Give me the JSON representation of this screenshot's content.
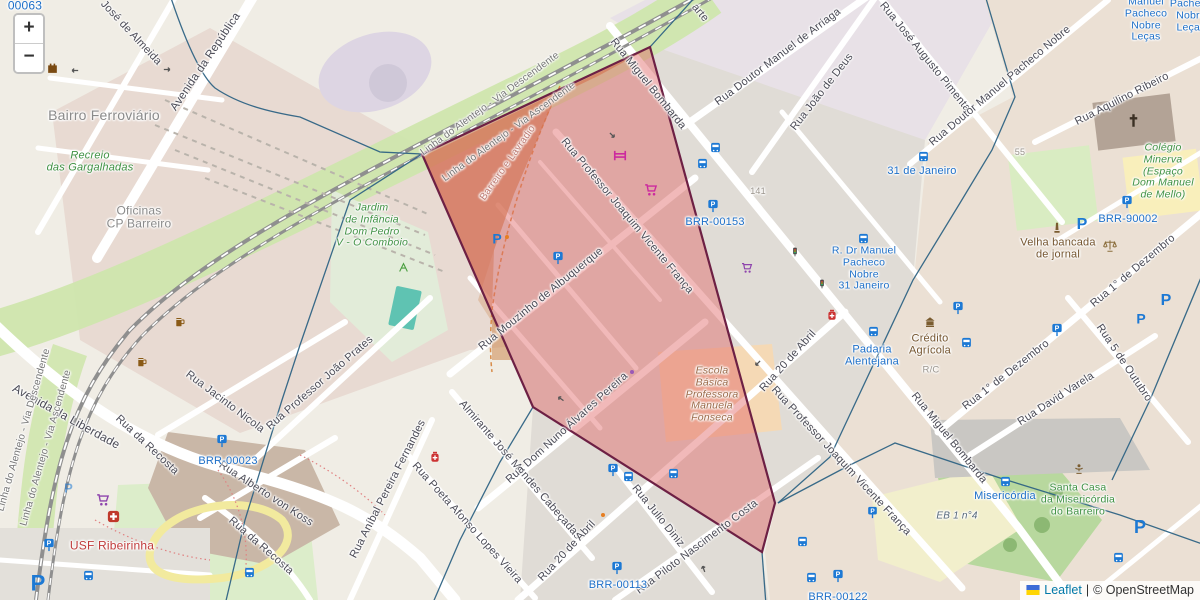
{
  "controls": {
    "zoom_in": "+",
    "zoom_out": "−"
  },
  "attribution": {
    "flag_icon": "ukraine-flag-icon",
    "leaflet_link": "Leaflet",
    "separator": "|",
    "copyright": "© OpenStreetMap"
  },
  "colors": {
    "street_label": "#4a4a55",
    "rail_label": "#767676",
    "place_label": "#8a8a8a",
    "green_poi": "#3f9143",
    "brown_poi": "#75552f",
    "school_brown": "#9c6b4a",
    "red_poi": "#c03c3c",
    "transit_blue": "#1d6fc8",
    "admin_label": "#bd7a72",
    "housenum": "#9a948c",
    "eb_label": "#56687a",
    "boundary_blue": "#2e6384",
    "polygon_fill": "#e06666",
    "polygon_border": "#6d2044",
    "attr_link": "#0078a8"
  },
  "polygon": {
    "name": "highlighted-red-zone",
    "points": "650,47 775,503 762,552 533,407 422,154"
  },
  "labels": [
    {
      "id": "corner-id",
      "text": "00063",
      "x": 25,
      "y": 6,
      "rot": 0,
      "size": 12,
      "c": "transit"
    },
    {
      "id": "jose-de-almeida",
      "text": "José de Almeida",
      "x": 131,
      "y": 33,
      "rot": 47,
      "size": 11,
      "c": "street"
    },
    {
      "id": "avenida-republica",
      "text": "Avenida da República",
      "x": 206,
      "y": 62,
      "rot": -56,
      "size": 11.5,
      "c": "street"
    },
    {
      "id": "avenida-liberdade",
      "text": "Avenida da Liberdade",
      "x": 66,
      "y": 417,
      "rot": 29,
      "size": 12,
      "c": "street"
    },
    {
      "id": "linha-desc-top",
      "text": "Linha do Alentejo - Via Descendente",
      "x": 490,
      "y": 104,
      "rot": -36,
      "size": 10,
      "c": "rail"
    },
    {
      "id": "linha-asc-top",
      "text": "Linha do Alentejo - Via Ascendente",
      "x": 509,
      "y": 132,
      "rot": -36,
      "size": 10,
      "c": "rail"
    },
    {
      "id": "linha-desc-left",
      "text": "Linha do Alentejo - Via Descendente",
      "x": 24,
      "y": 430,
      "rot": -74,
      "size": 10,
      "c": "rail"
    },
    {
      "id": "linha-asc-left",
      "text": "Linha do Alentejo - Via Ascendente",
      "x": 46,
      "y": 448,
      "rot": -74,
      "size": 10,
      "c": "rail"
    },
    {
      "id": "recosta-1",
      "text": "Rua da Recosta",
      "x": 147,
      "y": 445,
      "rot": 43,
      "size": 11,
      "c": "street"
    },
    {
      "id": "recosta-2",
      "text": "Rua da Recosta",
      "x": 261,
      "y": 546,
      "rot": 41,
      "size": 11,
      "c": "street"
    },
    {
      "id": "jacinto-nicola",
      "text": "Rua Jacinto Nicola",
      "x": 225,
      "y": 402,
      "rot": 37,
      "size": 11,
      "c": "street"
    },
    {
      "id": "joao-prates",
      "text": "Rua Professor João Prates",
      "x": 320,
      "y": 383,
      "rot": -41,
      "size": 11,
      "c": "street"
    },
    {
      "id": "alberto-koss",
      "text": "Rua Alberto von Koss",
      "x": 266,
      "y": 494,
      "rot": 33,
      "size": 11,
      "c": "street"
    },
    {
      "id": "anibal-fernandes",
      "text": "Rua Aníbal Pereira Fernandes",
      "x": 388,
      "y": 489,
      "rot": -63,
      "size": 11,
      "c": "street"
    },
    {
      "id": "poeta-afonso",
      "text": "Rua Poeta Afonso Lopes Vieira",
      "x": 467,
      "y": 523,
      "rot": 48,
      "size": 11,
      "c": "street"
    },
    {
      "id": "almirante-cabecadas",
      "text": "Almirante José Mendes Cabeçadas",
      "x": 520,
      "y": 470,
      "rot": 49,
      "size": 11,
      "c": "street"
    },
    {
      "id": "dom-nuno",
      "text": "Rua Dom Nuno Álvares Pereira",
      "x": 567,
      "y": 428,
      "rot": -42,
      "size": 11,
      "c": "street"
    },
    {
      "id": "mouzinho",
      "text": "Rua Mouzinho de Albuquerque",
      "x": 541,
      "y": 299,
      "rot": -39,
      "size": 11,
      "c": "street"
    },
    {
      "id": "franca-top",
      "text": "Rua Professor Joaquim Vicente França",
      "x": 627,
      "y": 216,
      "rot": 50,
      "size": 11,
      "c": "street"
    },
    {
      "id": "franca-right",
      "text": "Rua Professor Joaquim Vicente França",
      "x": 841,
      "y": 461,
      "rot": 47,
      "size": 11,
      "c": "street"
    },
    {
      "id": "bombarda-top",
      "text": "Rua Miguel Bombarda",
      "x": 648,
      "y": 84,
      "rot": 51,
      "size": 11,
      "c": "street"
    },
    {
      "id": "bombarda-bottom",
      "text": "Rua Miguel Bombarda",
      "x": 949,
      "y": 438,
      "rot": 51,
      "size": 11,
      "c": "street"
    },
    {
      "id": "arriaga",
      "text": "Rua Doutor Manuel de Arriaga",
      "x": 778,
      "y": 57,
      "rot": -37,
      "size": 11,
      "c": "street"
    },
    {
      "id": "joao-deus",
      "text": "Rua João de Deus",
      "x": 822,
      "y": 92,
      "rot": -52,
      "size": 11,
      "c": "street"
    },
    {
      "id": "jose-pimenta",
      "text": "Rua José Augusto Pimenta",
      "x": 925,
      "y": 57,
      "rot": 51,
      "size": 11,
      "c": "street"
    },
    {
      "id": "pacheco-nobre-street",
      "text": "Rua Doutor Manuel Pacheco Nobre",
      "x": 1000,
      "y": 86,
      "rot": -40,
      "size": 11,
      "c": "street"
    },
    {
      "id": "aquilino-ribeiro",
      "text": "Rua Aquilino Ribeiro",
      "x": 1122,
      "y": 99,
      "rot": -27,
      "size": 11,
      "c": "street"
    },
    {
      "id": "dezembro-1",
      "text": "Rua 1° de Dezembro",
      "x": 1006,
      "y": 375,
      "rot": -38,
      "size": 11,
      "c": "street"
    },
    {
      "id": "dezembro-2",
      "text": "Rua 1° de Dezembro",
      "x": 1133,
      "y": 271,
      "rot": -40,
      "size": 11,
      "c": "street"
    },
    {
      "id": "outubro-5",
      "text": "Rua 5 de Outubro",
      "x": 1124,
      "y": 363,
      "rot": 56,
      "size": 11,
      "c": "street"
    },
    {
      "id": "david-varela",
      "text": "Rua David Varela",
      "x": 1056,
      "y": 399,
      "rot": -33,
      "size": 11,
      "c": "street"
    },
    {
      "id": "abril-20-1",
      "text": "Rua 20 de Abril",
      "x": 567,
      "y": 551,
      "rot": -47,
      "size": 11,
      "c": "street"
    },
    {
      "id": "abril-20-2",
      "text": "Rua 20 de Abril",
      "x": 788,
      "y": 361,
      "rot": -48,
      "size": 11,
      "c": "street"
    },
    {
      "id": "julio-diniz",
      "text": "Rua Julio Diniz",
      "x": 658,
      "y": 516,
      "rot": 51,
      "size": 11,
      "c": "street"
    },
    {
      "id": "piloto-nascimento",
      "text": "Rua Piloto Nascimento Costa",
      "x": 697,
      "y": 547,
      "rot": -37,
      "size": 11,
      "c": "street"
    },
    {
      "id": "barreiro-lavradio",
      "text": "Barreiro e Lavradio",
      "x": 508,
      "y": 163,
      "rot": -55,
      "size": 10,
      "c": "admin"
    },
    {
      "id": "arte-partial",
      "text": "arte",
      "x": 700,
      "y": 13,
      "rot": 50,
      "size": 11,
      "c": "street"
    },
    {
      "id": "bairro-ferroviario",
      "text": "Bairro Ferroviário",
      "x": 104,
      "y": 116,
      "rot": 0,
      "size": 14,
      "c": "place"
    },
    {
      "id": "recreio",
      "lines": [
        "Recreio",
        "das Gargalhadas"
      ],
      "x": 90,
      "y": 162,
      "rot": 0,
      "size": 11,
      "c": "green",
      "italic": true
    },
    {
      "id": "oficinas",
      "lines": [
        "Oficinas",
        "CP Barreiro"
      ],
      "x": 139,
      "y": 218,
      "rot": 0,
      "size": 12,
      "c": "place"
    },
    {
      "id": "jardim-infancia",
      "lines": [
        "Jardim",
        "de Infância",
        "Dom Pedro",
        "V - O Comboio"
      ],
      "x": 372,
      "y": 226,
      "rot": 0,
      "size": 10.5,
      "c": "green",
      "italic": true
    },
    {
      "id": "escola-basica",
      "lines": [
        "Escola",
        "Básica",
        "Professora",
        "Manuela",
        "Fonseca"
      ],
      "x": 712,
      "y": 395,
      "rot": 0,
      "size": 10.5,
      "c": "school",
      "italic": true
    },
    {
      "id": "colegio-minerva",
      "lines": [
        "Colégio",
        "Minerva",
        "(Espaço",
        "Dom Manuel",
        "de Mello)"
      ],
      "x": 1163,
      "y": 172,
      "rot": 0,
      "size": 10.5,
      "c": "green",
      "italic": true
    },
    {
      "id": "velha-bancada",
      "lines": [
        "Velha bancada",
        "de jornal"
      ],
      "x": 1058,
      "y": 249,
      "rot": 0,
      "size": 11,
      "c": "brown"
    },
    {
      "id": "santa-casa",
      "lines": [
        "Santa Casa",
        "da Misericórdia",
        "do Barreiro"
      ],
      "x": 1078,
      "y": 500,
      "rot": 0,
      "size": 10.5,
      "c": "green"
    },
    {
      "id": "credito-agricola",
      "lines": [
        "Crédito",
        "Agrícola"
      ],
      "x": 930,
      "y": 345,
      "rot": 0,
      "size": 11,
      "c": "brown"
    },
    {
      "id": "usf-ribeirinha",
      "text": "USF Ribeirinha",
      "x": 112,
      "y": 546,
      "rot": 0,
      "size": 12,
      "c": "red"
    },
    {
      "id": "eb-1-n4",
      "text": "EB 1 n°4",
      "x": 957,
      "y": 516,
      "rot": 0,
      "size": 10,
      "c": "eb",
      "italic": true
    },
    {
      "id": "brr-00153",
      "text": "BRR-00153",
      "x": 715,
      "y": 222,
      "rot": 0,
      "size": 11,
      "c": "transit"
    },
    {
      "id": "brr-00023",
      "text": "BRR-00023",
      "x": 228,
      "y": 461,
      "rot": 0,
      "size": 11,
      "c": "transit"
    },
    {
      "id": "brr-00113",
      "text": "BRR-00113",
      "x": 618,
      "y": 585,
      "rot": 0,
      "size": 11,
      "c": "transit"
    },
    {
      "id": "brr-00122",
      "text": "BRR-00122",
      "x": 838,
      "y": 597,
      "rot": 0,
      "size": 11,
      "c": "transit"
    },
    {
      "id": "brr-90002",
      "text": "BRR-90002",
      "x": 1128,
      "y": 219,
      "rot": 0,
      "size": 11,
      "c": "transit"
    },
    {
      "id": "stop-31-janeiro",
      "text": "31 de Janeiro",
      "x": 922,
      "y": 171,
      "rot": 0,
      "size": 11,
      "c": "transit"
    },
    {
      "id": "stop-pacheco-nobre",
      "lines": [
        "R. Dr Manuel",
        "Pacheco",
        "Nobre",
        "31 Janeiro"
      ],
      "x": 864,
      "y": 269,
      "rot": 0,
      "size": 10.5,
      "c": "transit"
    },
    {
      "id": "stop-padaria",
      "lines": [
        "Padaria",
        "Alentejana"
      ],
      "x": 872,
      "y": 356,
      "rot": 0,
      "size": 11,
      "c": "transit"
    },
    {
      "id": "stop-misericordia",
      "text": "Misericórdia",
      "x": 1005,
      "y": 496,
      "rot": 0,
      "size": 11,
      "c": "transit"
    },
    {
      "id": "stop-lecas-1",
      "lines": [
        "Manuel",
        "Pacheco",
        "Nobre",
        "Leças"
      ],
      "x": 1146,
      "y": 20,
      "rot": 0,
      "size": 10.5,
      "c": "transit"
    },
    {
      "id": "stop-lecas-2",
      "lines": [
        "Pacheco",
        "Nobre",
        "Leças"
      ],
      "x": 1191,
      "y": 16,
      "rot": 0,
      "size": 10.5,
      "c": "transit"
    },
    {
      "id": "housenum-141",
      "text": "141",
      "x": 758,
      "y": 191,
      "rot": 0,
      "size": 9,
      "c": "num"
    },
    {
      "id": "housenum-55",
      "text": "55",
      "x": 1020,
      "y": 152,
      "rot": 0,
      "size": 9,
      "c": "num"
    },
    {
      "id": "housenum-rc",
      "text": "R/C",
      "x": 931,
      "y": 371,
      "rot": 0,
      "size": 9.5,
      "c": "num"
    }
  ],
  "icons": [
    {
      "type": "bus",
      "x": 715,
      "y": 147,
      "size": 11
    },
    {
      "type": "bus",
      "x": 702,
      "y": 163,
      "size": 11
    },
    {
      "type": "bus",
      "x": 923,
      "y": 156,
      "size": 11
    },
    {
      "type": "bus",
      "x": 863,
      "y": 238,
      "size": 11
    },
    {
      "type": "bus",
      "x": 873,
      "y": 331,
      "size": 11
    },
    {
      "type": "bus",
      "x": 966,
      "y": 342,
      "size": 11
    },
    {
      "type": "bus",
      "x": 1005,
      "y": 481,
      "size": 11
    },
    {
      "type": "bus",
      "x": 1118,
      "y": 557,
      "size": 11
    },
    {
      "type": "bus",
      "x": 802,
      "y": 541,
      "size": 11
    },
    {
      "type": "bus",
      "x": 811,
      "y": 577,
      "size": 11
    },
    {
      "type": "bus",
      "x": 628,
      "y": 476,
      "size": 11
    },
    {
      "type": "bus",
      "x": 673,
      "y": 473,
      "size": 11
    },
    {
      "type": "bus",
      "x": 88,
      "y": 575,
      "size": 11
    },
    {
      "type": "bus",
      "x": 249,
      "y": 572,
      "size": 11
    },
    {
      "type": "parking-meter",
      "x": 713,
      "y": 206,
      "size": 14
    },
    {
      "type": "parking-meter",
      "x": 222,
      "y": 441,
      "size": 14
    },
    {
      "type": "parking-meter",
      "x": 617,
      "y": 568,
      "size": 14
    },
    {
      "type": "parking-meter",
      "x": 838,
      "y": 576,
      "size": 14
    },
    {
      "type": "parking-meter",
      "x": 1127,
      "y": 202,
      "size": 14
    },
    {
      "type": "parking-meter",
      "x": 558,
      "y": 258,
      "size": 14
    },
    {
      "type": "parking-meter",
      "x": 613,
      "y": 470,
      "size": 14
    },
    {
      "type": "parking-meter",
      "x": 958,
      "y": 308,
      "size": 14
    },
    {
      "type": "parking-meter",
      "x": 1057,
      "y": 330,
      "size": 14
    },
    {
      "type": "parking-meter",
      "x": 49,
      "y": 545,
      "size": 14
    },
    {
      "type": "parking-meter",
      "x": 872,
      "y": 512,
      "size": 13
    },
    {
      "type": "parking-p",
      "x": 497,
      "y": 238,
      "size": 14
    },
    {
      "type": "parking-p",
      "x": 38,
      "y": 582,
      "size": 22
    },
    {
      "type": "parking-p",
      "x": 1082,
      "y": 223,
      "size": 16
    },
    {
      "type": "parking-p",
      "x": 1166,
      "y": 299,
      "size": 16
    },
    {
      "type": "parking-p",
      "x": 1141,
      "y": 318,
      "size": 14
    },
    {
      "type": "parking-p",
      "x": 1140,
      "y": 526,
      "size": 18
    },
    {
      "type": "parking-p",
      "x": 68,
      "y": 487,
      "size": 13,
      "opacity": 0.55
    },
    {
      "type": "shopping-cart",
      "x": 651,
      "y": 190,
      "size": 14,
      "color": "#cc2a9e"
    },
    {
      "type": "shopping-cart",
      "x": 747,
      "y": 268,
      "size": 12,
      "color": "#8e44ad"
    },
    {
      "type": "shopping-cart",
      "x": 103,
      "y": 500,
      "size": 14,
      "color": "#8e44ad"
    },
    {
      "type": "bunk-bed",
      "x": 620,
      "y": 155,
      "size": 14,
      "color": "#cc2a9e"
    },
    {
      "type": "church-cross",
      "x": 1133,
      "y": 120,
      "size": 15,
      "color": "#3b3024"
    },
    {
      "type": "scales",
      "x": 1110,
      "y": 246,
      "size": 14,
      "color": "#8a6d3b"
    },
    {
      "type": "monument",
      "x": 1057,
      "y": 228,
      "size": 12,
      "color": "#7a5c30"
    },
    {
      "type": "bank",
      "x": 930,
      "y": 322,
      "size": 12,
      "color": "#7a5c30"
    },
    {
      "type": "clinic",
      "x": 113,
      "y": 516,
      "size": 13
    },
    {
      "type": "pharmacy",
      "x": 832,
      "y": 315,
      "size": 12,
      "color": "#cc3333"
    },
    {
      "type": "pharmacy",
      "x": 435,
      "y": 457,
      "size": 12,
      "color": "#cc3333"
    },
    {
      "type": "beer",
      "x": 180,
      "y": 322,
      "size": 12,
      "color": "#8a5a16"
    },
    {
      "type": "beer",
      "x": 142,
      "y": 362,
      "size": 12,
      "color": "#8a5a16"
    },
    {
      "type": "castle",
      "x": 52,
      "y": 67,
      "size": 13,
      "color": "#7a4a12"
    },
    {
      "type": "playground",
      "x": 403,
      "y": 267,
      "size": 11,
      "color": "#4a9e3f"
    },
    {
      "type": "fountain",
      "x": 1079,
      "y": 469,
      "size": 12,
      "color": "#7a5c30"
    },
    {
      "type": "traffic-light",
      "x": 795,
      "y": 252,
      "size": 10
    },
    {
      "type": "traffic-light",
      "x": 822,
      "y": 284,
      "size": 10
    },
    {
      "type": "oneway-arrow",
      "x": 74,
      "y": 70,
      "size": 11,
      "rot": 180
    },
    {
      "type": "oneway-arrow",
      "x": 167,
      "y": 69,
      "size": 11,
      "rot": 0
    },
    {
      "type": "oneway-arrow",
      "x": 612,
      "y": 135,
      "size": 11,
      "rot": 45
    },
    {
      "type": "oneway-arrow",
      "x": 560,
      "y": 398,
      "size": 11,
      "rot": 215
    },
    {
      "type": "oneway-arrow",
      "x": 757,
      "y": 363,
      "size": 11,
      "rot": 135
    },
    {
      "type": "oneway-arrow",
      "x": 703,
      "y": 568,
      "size": 11,
      "rot": 250
    },
    {
      "type": "poi-dot",
      "x": 632,
      "y": 372,
      "size": 8,
      "color": "#9b59b6"
    },
    {
      "type": "poi-dot",
      "x": 507,
      "y": 237,
      "size": 8,
      "color": "#e67e22"
    },
    {
      "type": "poi-dot",
      "x": 603,
      "y": 515,
      "size": 8,
      "color": "#e67e22"
    }
  ]
}
